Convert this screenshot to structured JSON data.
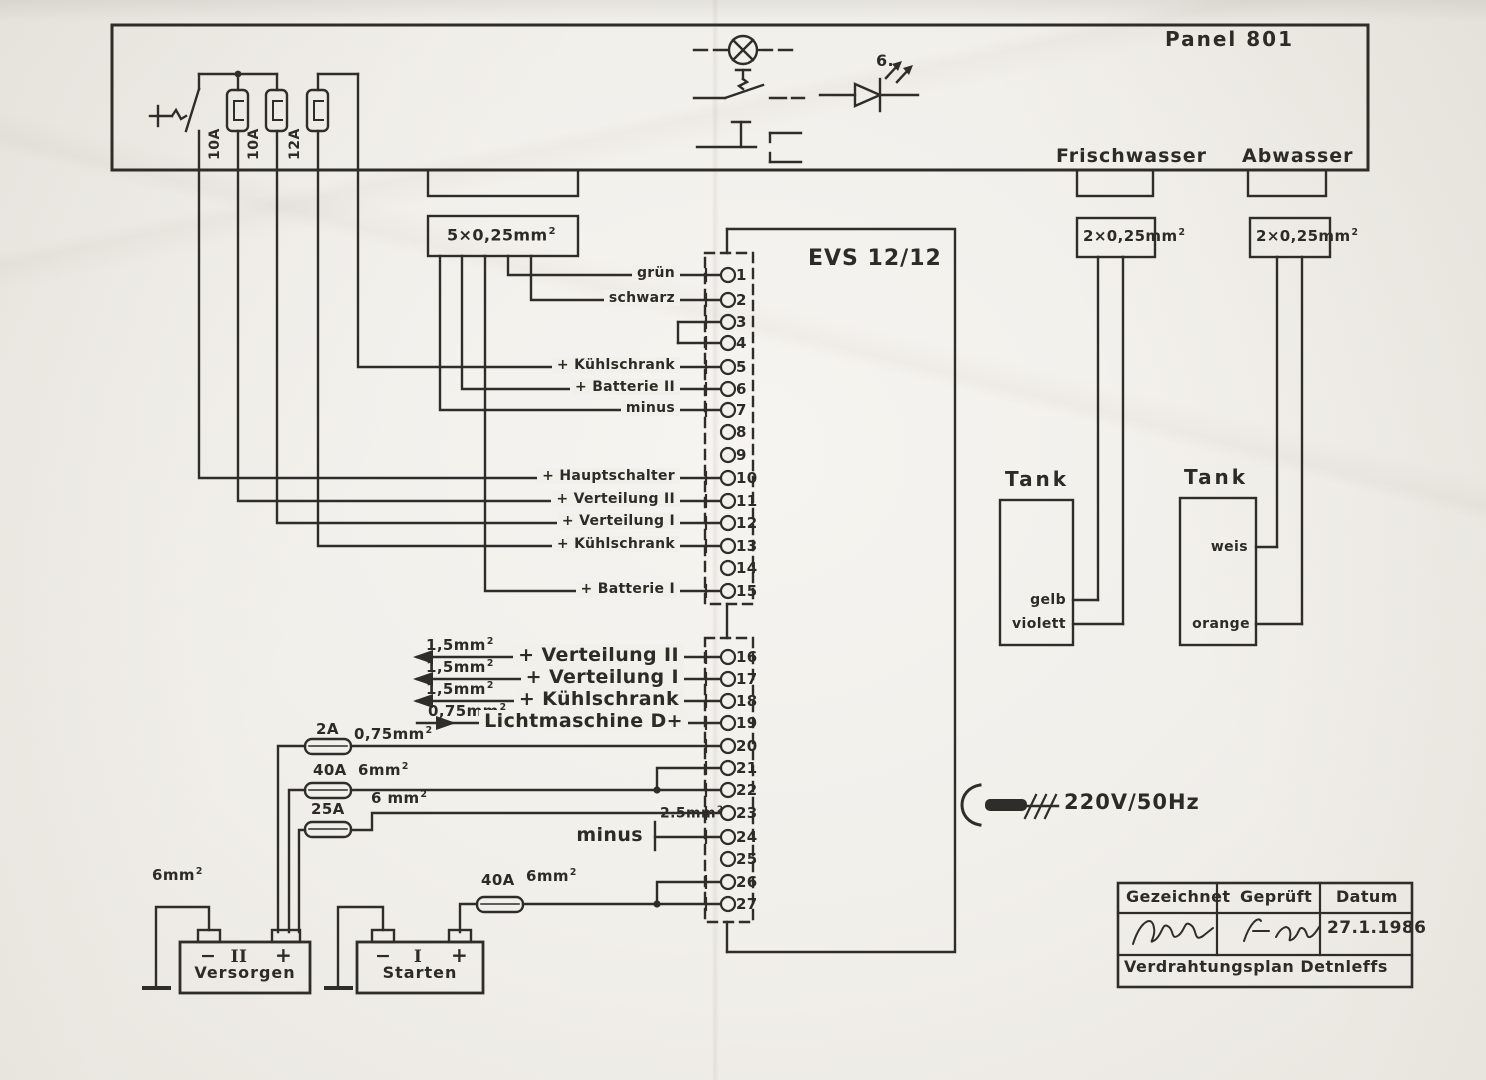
{
  "panel": {
    "title": "Panel 801",
    "fuse_labels": [
      "10A",
      "10A",
      "12A"
    ],
    "led_number": "6.",
    "fresh_water_label": "Frischwasser",
    "waste_water_label": "Abwasser"
  },
  "cables": {
    "harness": {
      "base": "5×0,25mm",
      "sup": "2"
    },
    "fresh": {
      "base": "2×0,25mm",
      "sup": "2"
    },
    "waste": {
      "base": "2×0,25mm",
      "sup": "2"
    }
  },
  "tanks": {
    "fresh": {
      "title": "Tank",
      "wire_top": "gelb",
      "wire_bottom": "violett"
    },
    "waste": {
      "title": "Tank",
      "wire_top": "weis",
      "wire_bottom": "orange"
    }
  },
  "connector": {
    "title": "EVS 12/12",
    "pins": [
      {
        "n": "1",
        "label": "grün"
      },
      {
        "n": "2",
        "label": "schwarz"
      },
      {
        "n": "3",
        "label": ""
      },
      {
        "n": "4",
        "label": ""
      },
      {
        "n": "5",
        "label": "+ Kühlschrank"
      },
      {
        "n": "6",
        "label": "+ Batterie II"
      },
      {
        "n": "7",
        "label": "minus"
      },
      {
        "n": "8",
        "label": ""
      },
      {
        "n": "9",
        "label": ""
      },
      {
        "n": "10",
        "label": "+ Hauptschalter"
      },
      {
        "n": "11",
        "label": "+ Verteilung II"
      },
      {
        "n": "12",
        "label": "+ Verteilung I"
      },
      {
        "n": "13",
        "label": "+ Kühlschrank"
      },
      {
        "n": "14",
        "label": ""
      },
      {
        "n": "15",
        "label": "+ Batterie I"
      },
      {
        "n": "16",
        "label": "+ Verteilung II"
      },
      {
        "n": "17",
        "label": "+ Verteilung I"
      },
      {
        "n": "18",
        "label": "+ Kühlschrank"
      },
      {
        "n": "19",
        "label": "Lichtmaschine D+"
      },
      {
        "n": "20",
        "label": ""
      },
      {
        "n": "21",
        "label": ""
      },
      {
        "n": "22",
        "label": ""
      },
      {
        "n": "23",
        "label": ""
      },
      {
        "n": "24",
        "label": "minus"
      },
      {
        "n": "25",
        "label": ""
      },
      {
        "n": "26",
        "label": ""
      },
      {
        "n": "27",
        "label": ""
      }
    ]
  },
  "wire_specs": {
    "pin16": {
      "base": "1,5mm",
      "sup": "2"
    },
    "pin17": {
      "base": "1,5mm",
      "sup": "2"
    },
    "pin18": {
      "base": "1,5mm",
      "sup": "2"
    },
    "pin19": {
      "base": "0,75mm",
      "sup": "2"
    },
    "pin20": {
      "base": "0,75mm",
      "sup": "2"
    },
    "pin22": {
      "base": "6mm",
      "sup": "2"
    },
    "pin23": {
      "base": "6 mm",
      "sup": "2"
    },
    "pin24": {
      "base": "2.5mm",
      "sup": "2"
    },
    "starter_feed": {
      "base": "6mm",
      "sup": "2"
    },
    "supply_ground": {
      "base": "6mm",
      "sup": "2"
    }
  },
  "fuse_ratings": {
    "pin20": "2A",
    "pin22": "40A",
    "pin23": "25A",
    "starter": "40A"
  },
  "power": {
    "mains": "220V/50Hz"
  },
  "batteries": {
    "supply": {
      "minus": "−",
      "roman": "II",
      "plus": "+",
      "name": "Versorgen"
    },
    "starter": {
      "minus": "−",
      "roman": "I",
      "plus": "+",
      "name": "Starten"
    }
  },
  "title_block": {
    "drawn_header": "Gezeichnet",
    "checked_header": "Geprüft",
    "date_header": "Datum",
    "date": "27.1.1986",
    "drawing_title": "Verdrahtungsplan Detnleffs"
  }
}
